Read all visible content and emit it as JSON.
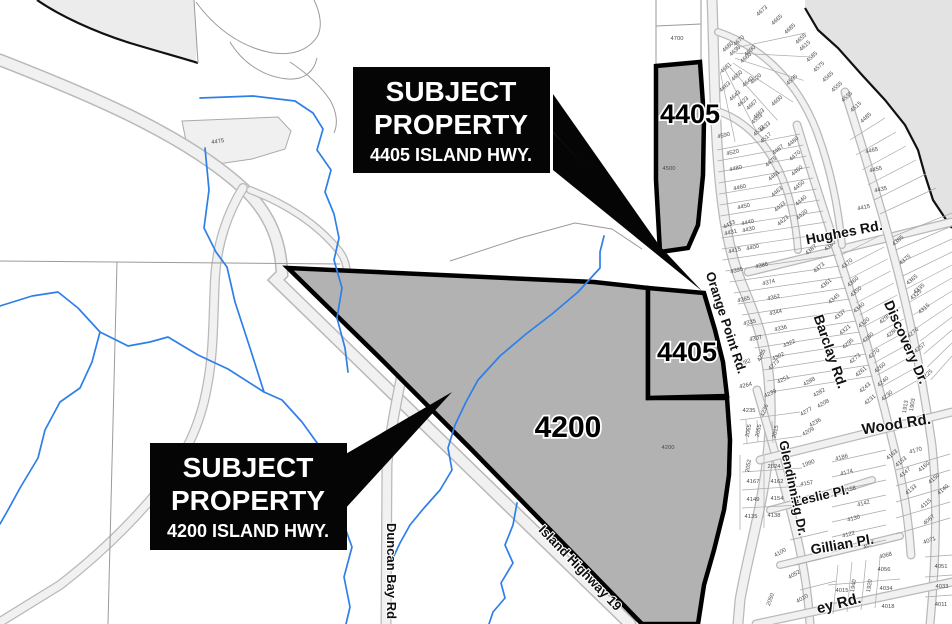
{
  "map": {
    "colors": {
      "subject_fill": "#b2b2b2",
      "water": "#e3e3e3",
      "stream": "#2e7fe8",
      "road_fill": "#f1f1f1",
      "road_casing": "#b9b9b9",
      "callout_bg": "#050505",
      "callout_text": "#ffffff"
    },
    "callouts": [
      {
        "id": "4405",
        "line1": "SUBJECT",
        "line2": "PROPERTY",
        "line3": "4405 ISLAND HWY."
      },
      {
        "id": "4200",
        "line1": "SUBJECT",
        "line2": "PROPERTY",
        "line3": "4200 ISLAND HWY."
      }
    ],
    "bold_labels": [
      {
        "text": "4405",
        "x": 690,
        "y": 123,
        "size": 27
      },
      {
        "text": "4405",
        "x": 687,
        "y": 361,
        "size": 27
      },
      {
        "text": "4200",
        "x": 568,
        "y": 437,
        "size": 30
      }
    ],
    "road_labels": [
      {
        "text": "Orange Point Rd.",
        "x": 722,
        "y": 324,
        "rot": 72,
        "size": 13
      },
      {
        "text": "Hughes Rd.",
        "x": 845,
        "y": 237,
        "rot": -11,
        "size": 14
      },
      {
        "text": "Barclay Rd.",
        "x": 826,
        "y": 353,
        "rot": 71,
        "size": 14
      },
      {
        "text": "Discovery Dr.",
        "x": 902,
        "y": 344,
        "rot": 66,
        "size": 14
      },
      {
        "text": "Glendinning Dr.",
        "x": 789,
        "y": 489,
        "rot": 78,
        "size": 13
      },
      {
        "text": "Wood Rd.",
        "x": 897,
        "y": 429,
        "rot": -9,
        "size": 15
      },
      {
        "text": "Leslie Pl.",
        "x": 822,
        "y": 500,
        "rot": -13,
        "size": 13
      },
      {
        "text": "Gillian Pl.",
        "x": 843,
        "y": 549,
        "rot": -10,
        "size": 14
      },
      {
        "text": "Duncan Bay Rd",
        "x": 387,
        "y": 571,
        "rot": 90,
        "size": 13
      },
      {
        "text": "Island Highway 19",
        "x": 577,
        "y": 571,
        "rot": 46,
        "size": 13
      },
      {
        "text": "ey Rd.",
        "x": 840,
        "y": 608,
        "rot": -14,
        "size": 15
      }
    ],
    "parcel_labels": [
      [
        "4700",
        677,
        40,
        0,
        7
      ],
      [
        "4500",
        669,
        170,
        0,
        6
      ],
      [
        "4200",
        668,
        449,
        0,
        7
      ],
      [
        "4475",
        218,
        143,
        -8,
        7
      ],
      [
        "2050",
        772,
        600,
        -70
      ],
      [
        "4673",
        763,
        12,
        -42
      ],
      [
        "4665",
        778,
        21,
        -42
      ],
      [
        "4685",
        791,
        30,
        -42
      ],
      [
        "4655",
        802,
        40,
        -42
      ],
      [
        "4615",
        806,
        47,
        -42
      ],
      [
        "4585",
        813,
        58,
        -42
      ],
      [
        "4575",
        820,
        68,
        -42
      ],
      [
        "4565",
        829,
        78,
        -42
      ],
      [
        "4555",
        838,
        88,
        -42
      ],
      [
        "4535",
        848,
        98,
        -42
      ],
      [
        "4515",
        857,
        108,
        -42
      ],
      [
        "4485",
        867,
        119,
        -42
      ],
      [
        "4680",
        729,
        48,
        -42
      ],
      [
        "4670",
        740,
        42,
        -42
      ],
      [
        "4690",
        751,
        52,
        -42
      ],
      [
        "4630",
        736,
        52,
        -42
      ],
      [
        "4660",
        747,
        59,
        -42
      ],
      [
        "4681",
        727,
        69,
        -42
      ],
      [
        "4650",
        738,
        77,
        -42
      ],
      [
        "4640",
        749,
        83,
        -42
      ],
      [
        "4620",
        757,
        80,
        -42
      ],
      [
        "4663",
        726,
        88,
        -42
      ],
      [
        "4643",
        736,
        97,
        -42
      ],
      [
        "4623",
        744,
        103,
        -42
      ],
      [
        "4667",
        753,
        106,
        -42
      ],
      [
        "4653",
        760,
        115,
        -42
      ],
      [
        "4633",
        766,
        128,
        -42
      ],
      [
        "4600",
        778,
        102,
        -42
      ],
      [
        "4553",
        758,
        120,
        -42
      ],
      [
        "4533",
        760,
        132,
        -42
      ],
      [
        "4517",
        767,
        139,
        -42
      ],
      [
        "4595",
        793,
        81,
        -42
      ],
      [
        "4590",
        724,
        137,
        -13
      ],
      [
        "4520",
        733,
        154,
        -13
      ],
      [
        "4480",
        736,
        170,
        -13
      ],
      [
        "4460",
        740,
        189,
        -13
      ],
      [
        "4450",
        744,
        208,
        -13
      ],
      [
        "4433",
        730,
        226,
        -28
      ],
      [
        "4440",
        748,
        224,
        -13
      ],
      [
        "4431",
        731,
        234,
        -13
      ],
      [
        "4430",
        749,
        231,
        -13
      ],
      [
        "4415",
        735,
        252,
        -13
      ],
      [
        "4400",
        753,
        249,
        -13
      ],
      [
        "4395",
        737,
        272,
        -13
      ],
      [
        "4386",
        762,
        267,
        -13
      ],
      [
        "4374",
        769,
        284,
        -13
      ],
      [
        "4365",
        744,
        301,
        -13
      ],
      [
        "4362",
        774,
        299,
        -13
      ],
      [
        "4344",
        776,
        314,
        -13
      ],
      [
        "4335",
        750,
        324,
        -13
      ],
      [
        "4336",
        781,
        330,
        -13
      ],
      [
        "4307",
        756,
        340,
        -13
      ],
      [
        "4322",
        790,
        345,
        -25
      ],
      [
        "4302",
        779,
        358,
        -25
      ],
      [
        "4285",
        763,
        356,
        -65
      ],
      [
        "4273",
        775,
        366,
        -45
      ],
      [
        "4282",
        745,
        364,
        -18
      ],
      [
        "4264",
        746,
        387,
        -13
      ],
      [
        "4251",
        784,
        381,
        -25
      ],
      [
        "4239",
        771,
        395,
        -25
      ],
      [
        "4235",
        749,
        412,
        0
      ],
      [
        "4236",
        766,
        411,
        -70
      ],
      [
        "2065",
        750,
        431,
        -78
      ],
      [
        "2055",
        760,
        431,
        -78
      ],
      [
        "2015",
        777,
        432,
        -78
      ],
      [
        "4487",
        779,
        151,
        -40
      ],
      [
        "4475",
        772,
        163,
        -40
      ],
      [
        "4461",
        775,
        177,
        -40
      ],
      [
        "4463",
        778,
        193,
        -40
      ],
      [
        "4433",
        781,
        208,
        -40
      ],
      [
        "4423",
        784,
        222,
        -40
      ],
      [
        "4480",
        794,
        143,
        -40
      ],
      [
        "4470",
        796,
        157,
        -40
      ],
      [
        "4460",
        798,
        172,
        -40
      ],
      [
        "4450",
        800,
        187,
        -40
      ],
      [
        "4440",
        802,
        202,
        -40
      ],
      [
        "4420",
        803,
        216,
        -40
      ],
      [
        "4387",
        812,
        251,
        -40
      ],
      [
        "4380",
        831,
        247,
        -40
      ],
      [
        "4373",
        820,
        269,
        -40
      ],
      [
        "4370",
        848,
        265,
        -40
      ],
      [
        "4361",
        827,
        285,
        -40
      ],
      [
        "4360",
        854,
        283,
        -40
      ],
      [
        "4345",
        835,
        300,
        -40
      ],
      [
        "4350",
        857,
        293,
        -40
      ],
      [
        "4337",
        841,
        316,
        -40
      ],
      [
        "4340",
        860,
        309,
        -40
      ],
      [
        "4321",
        846,
        331,
        -40
      ],
      [
        "4320",
        865,
        324,
        -40
      ],
      [
        "4295",
        849,
        345,
        -40
      ],
      [
        "4280",
        869,
        339,
        -40
      ],
      [
        "4273",
        856,
        360,
        -40
      ],
      [
        "4270",
        875,
        355,
        -40
      ],
      [
        "4261",
        862,
        373,
        -40
      ],
      [
        "4260",
        881,
        369,
        -40
      ],
      [
        "4243",
        866,
        389,
        -40
      ],
      [
        "4240",
        884,
        383,
        -40
      ],
      [
        "4231",
        871,
        401,
        -40
      ],
      [
        "4230",
        888,
        397,
        -40
      ],
      [
        "4288",
        810,
        383,
        -30
      ],
      [
        "4282",
        820,
        394,
        -30
      ],
      [
        "4277",
        807,
        413,
        -30
      ],
      [
        "4236",
        816,
        424,
        -30
      ],
      [
        "4209",
        809,
        433,
        -30
      ],
      [
        "4208",
        824,
        405,
        -30
      ],
      [
        "4465",
        872,
        152,
        -12
      ],
      [
        "4455",
        876,
        171,
        -12
      ],
      [
        "4435",
        881,
        191,
        -12
      ],
      [
        "4415",
        864,
        209,
        -12
      ],
      [
        "4385",
        899,
        242,
        -40
      ],
      [
        "4375",
        906,
        261,
        -40
      ],
      [
        "4365",
        913,
        281,
        -40
      ],
      [
        "4335",
        920,
        290,
        -40
      ],
      [
        "4325",
        917,
        296,
        -40
      ],
      [
        "4315",
        925,
        310,
        -40
      ],
      [
        "4295",
        886,
        320,
        -40
      ],
      [
        "4280",
        893,
        334,
        -40
      ],
      [
        "4276",
        914,
        334,
        -40
      ],
      [
        "4257",
        921,
        349,
        -40
      ],
      [
        "4225",
        928,
        376,
        -40
      ],
      [
        "2052",
        750,
        466,
        -80
      ],
      [
        "2024",
        774,
        468,
        0
      ],
      [
        "1990",
        809,
        465,
        -20
      ],
      [
        "4167",
        753,
        483,
        0
      ],
      [
        "4162",
        777,
        483,
        0
      ],
      [
        "4157",
        807,
        485,
        -10
      ],
      [
        "4149",
        753,
        501,
        0
      ],
      [
        "4154",
        777,
        500,
        0
      ],
      [
        "4135",
        751,
        518,
        0
      ],
      [
        "4138",
        774,
        517,
        0
      ],
      [
        "4186",
        842,
        459,
        -15
      ],
      [
        "4174",
        847,
        474,
        -15
      ],
      [
        "4158",
        850,
        491,
        -15
      ],
      [
        "4142",
        864,
        505,
        -15
      ],
      [
        "4130",
        854,
        520,
        -15
      ],
      [
        "4122",
        849,
        536,
        -15
      ],
      [
        "4092",
        870,
        546,
        -30
      ],
      [
        "4100",
        781,
        554,
        -30
      ],
      [
        "4068",
        886,
        557,
        -15
      ],
      [
        "4056",
        884,
        571,
        0
      ],
      [
        "4034",
        886,
        590,
        0
      ],
      [
        "4018",
        888,
        608,
        0
      ],
      [
        "4015",
        842,
        592,
        0
      ],
      [
        "4010",
        803,
        600,
        -30
      ],
      [
        "4052",
        795,
        576,
        -30
      ],
      [
        "1940",
        855,
        586,
        -80
      ],
      [
        "1920",
        871,
        586,
        -80
      ],
      [
        "1913",
        907,
        407,
        -80
      ],
      [
        "1903",
        914,
        405,
        -80
      ],
      [
        "4051",
        941,
        568,
        0
      ],
      [
        "4033",
        942,
        588,
        0
      ],
      [
        "4011",
        941,
        606,
        0
      ],
      [
        "4071",
        930,
        542,
        -20
      ],
      [
        "4087",
        930,
        521,
        -40
      ],
      [
        "4115",
        927,
        505,
        -40
      ],
      [
        "4133",
        912,
        491,
        -40
      ],
      [
        "4147",
        906,
        474,
        -40
      ],
      [
        "4163",
        893,
        456,
        -40
      ],
      [
        "4153",
        902,
        463,
        -40
      ],
      [
        "4170",
        916,
        452,
        -15
      ],
      [
        "4160",
        925,
        468,
        -40
      ],
      [
        "4150",
        935,
        480,
        -40
      ],
      [
        "4140",
        944,
        491,
        -40
      ]
    ]
  }
}
